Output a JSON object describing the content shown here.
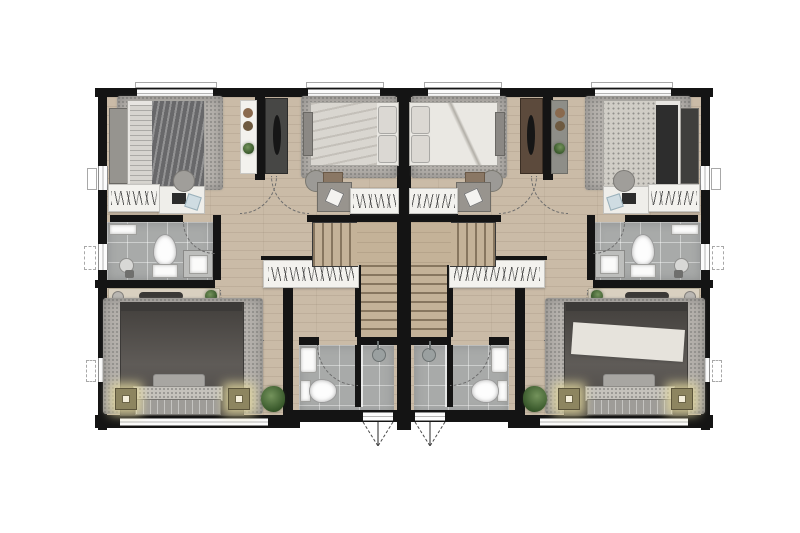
{
  "plan": {
    "kind": "residential floor plan, top-down render, two mirrored units",
    "visible_text": "none",
    "rooms_per_unit": [
      "front bedroom A",
      "front bedroom B",
      "upper bathroom",
      "hallway",
      "staircase",
      "master bedroom",
      "lower bathroom"
    ],
    "fixtures": [
      "bed",
      "rug",
      "headboard bench",
      "clothes rack with hangers",
      "desk",
      "stool",
      "console cabinet",
      "tall cabinet",
      "toilet",
      "sink vanity",
      "shower head",
      "closet with hangers",
      "nightstand lamp",
      "plant",
      "door swing arc",
      "window",
      "casement window symbol",
      "stairs"
    ]
  },
  "colors": {
    "background": "#ffffff",
    "wall": "#141414",
    "wood_floor": "#cabba7",
    "stair_wood": "#c4b298",
    "tile": "#a8aaa9",
    "rug": "#b5b1ac",
    "white_furniture": "#f3f2ee",
    "dark_furniture": "#474745",
    "duvet_dark": "#68686a",
    "duvet_light": "#d9d6d0",
    "master_duvet": "#55514d",
    "pillow_light": "#dbd8d3",
    "plant_green": "#4c6b3c",
    "lamp_base": "#8d8560",
    "lamp_glow": "#e4d9a0",
    "brown_cabinet": "#5c4a3c",
    "gray_cabinet": "#8e8e88"
  }
}
